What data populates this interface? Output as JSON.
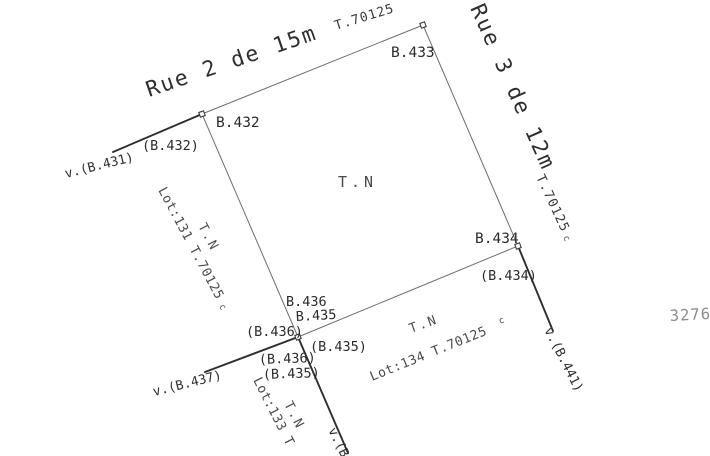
{
  "sheet": {
    "background": "#ffffff",
    "ink": "#2b2b2b",
    "thin_line_color": "#6e6e6e",
    "thick_line_color": "#2e2e2e",
    "margin_number": "3276",
    "margin_number_color": "#8d8d8d"
  },
  "streets": {
    "rue2": {
      "name": "Rue 2 de 15m",
      "ref": "T.70125"
    },
    "rue3": {
      "name": "Rue 3 de 12m",
      "ref": "T.70125",
      "ref_sup": "c"
    }
  },
  "parcel": {
    "terrain_label": "T.N"
  },
  "points": {
    "b432": {
      "label": "B.432",
      "paren": "(B.432)"
    },
    "b433": {
      "label": "B.433"
    },
    "b434": {
      "label": "B.434",
      "paren": "(B.434)"
    },
    "b435": {
      "label": "B.435",
      "paren_right": "(B.435)",
      "paren_below": "(B.435)"
    },
    "b436": {
      "label": "B.436",
      "paren_left": "(B.436)",
      "paren_below": "(B.436)"
    }
  },
  "witness": {
    "v431": "v.(B.431)",
    "v437": "v.(B.437)",
    "v441": "v.(B.441)",
    "v_cut": "v.(B."
  },
  "lots": {
    "lot131": {
      "terrain": "T.N",
      "label": "Lot:131 T.70125",
      "sup": "c"
    },
    "lot133": {
      "terrain": "T.N",
      "label": "Lot:133 T"
    },
    "lot134": {
      "terrain": "T.N",
      "label": "Lot:134 T.70125",
      "sup": "c"
    }
  }
}
